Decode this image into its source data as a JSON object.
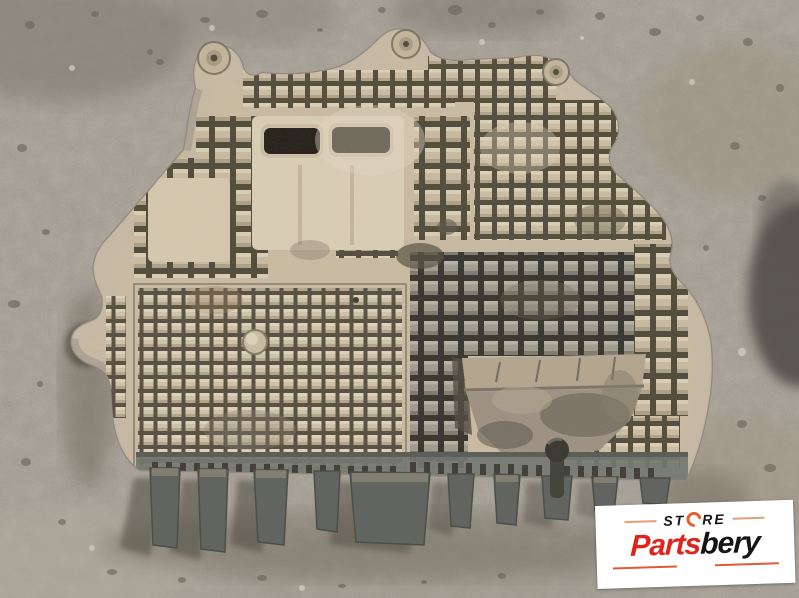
{
  "scene": {
    "description": "Used beige plastic engine undertray (belly pan) with waffle square-bump texture, two rectangular air slots and a smooth skid area, lying on grey gravel asphalt photographed from above",
    "ground_color": "#a39b8f",
    "tray_color": "#c9bba1",
    "tray_edge_color": "#8f8a7c",
    "slot_color": "#211d15",
    "shadow_color": "#4a453b"
  },
  "watermark": {
    "store_text_left": "ST",
    "store_text_right": "RE",
    "store_word": "STORE",
    "brand_red_text": "Parts",
    "brand_black_text": "bery",
    "brand_full": "Partsbery",
    "colors": {
      "red": "#e0231c",
      "black": "#141414",
      "orange_ring": "#e2622e",
      "accent_line": "#e2a077",
      "background": "#ffffff"
    }
  }
}
